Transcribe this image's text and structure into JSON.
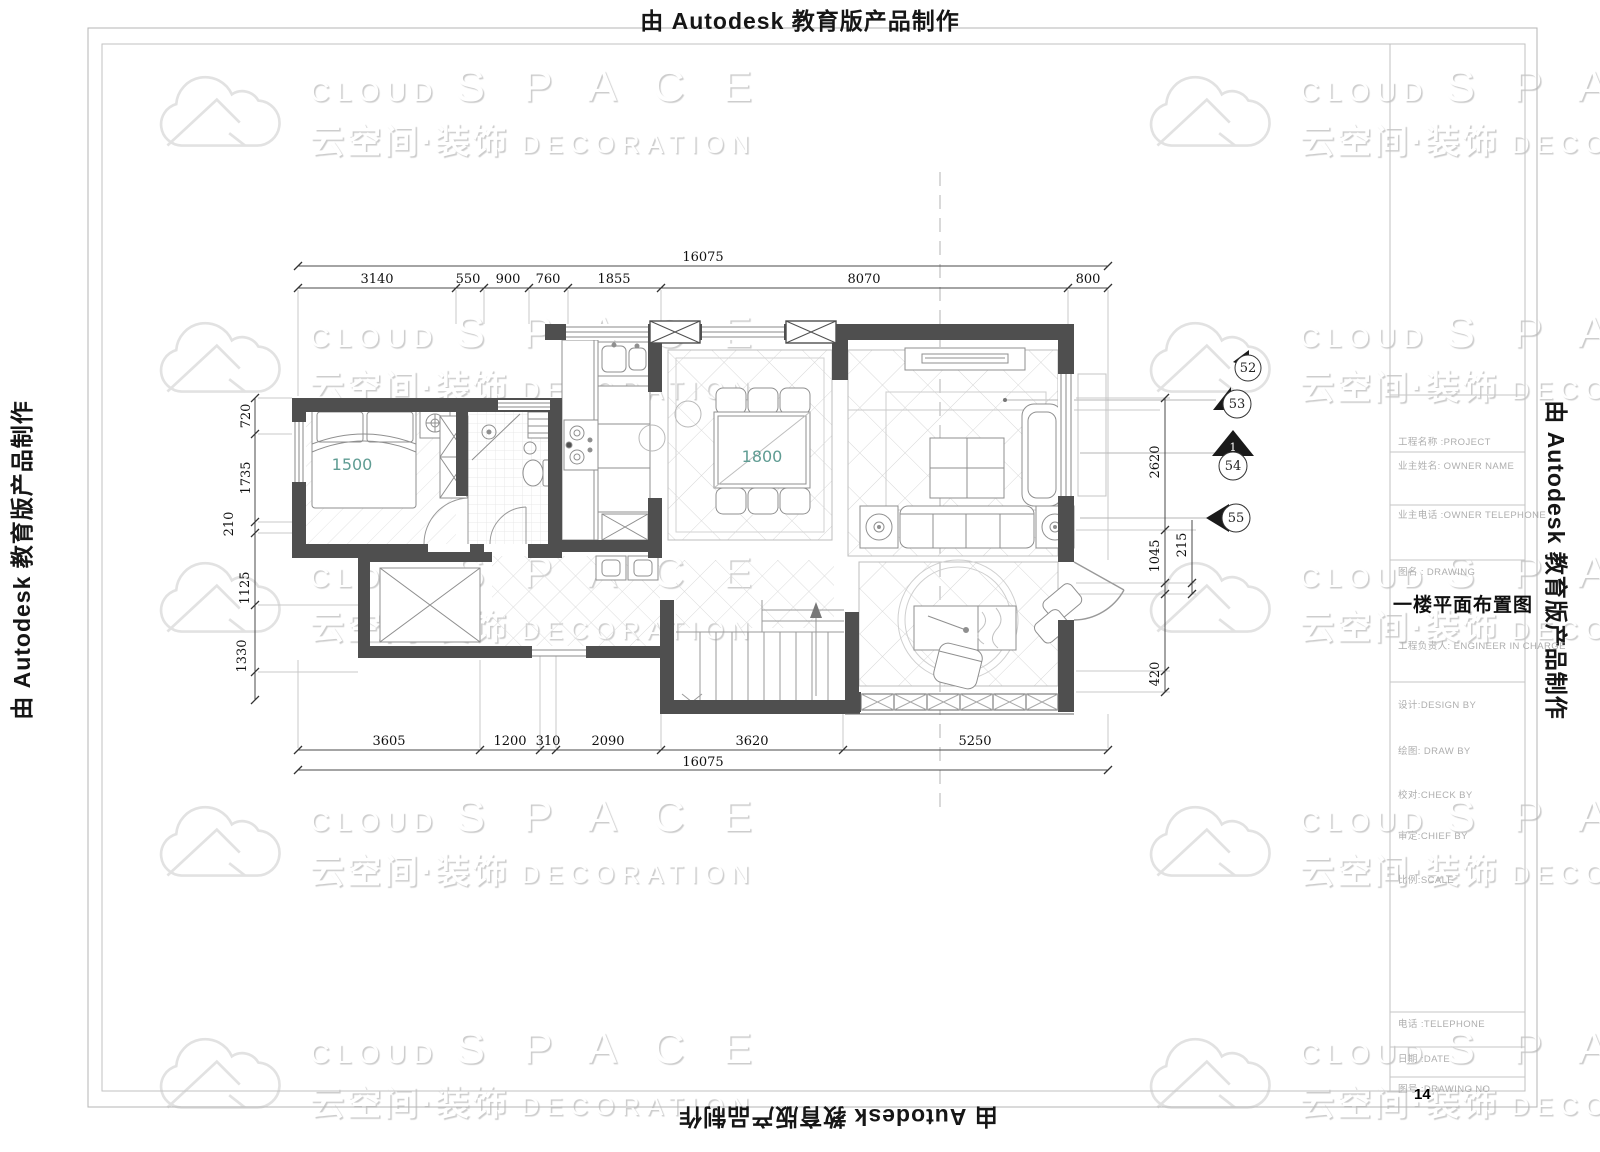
{
  "page": {
    "banner_text": "由 Autodesk 教育版产品制作"
  },
  "watermark": {
    "cloud": "CLOUD",
    "space": "S P A C E",
    "cjk": "云空间·装饰",
    "decoration": "DECORATION",
    "icon": "cloud-mountain-logo"
  },
  "title_block": {
    "project_label": "工程名称 :PROJECT",
    "owner_name_label": "业主姓名: OWNER NAME",
    "owner_tel_label": "业主电话 :OWNER TELEPHONE",
    "drawing_label": "图名 : DRAWING",
    "drawing_title": "一楼平面布置图",
    "engineer_label": "工程负责人: ENGINEER IN CHARGE",
    "design_label": "设计:DESIGN BY",
    "draw_label": "绘图: DRAW BY",
    "check_label": "校对:CHECK BY",
    "chief_label": "审定:CHIEF BY",
    "scale_label": "比例:SCALE",
    "telephone_label": "电话 :TELEPHONE",
    "date_label": "日期 :DATE",
    "drawing_no_label": "图号 :DRAWING NO",
    "drawing_no": "14"
  },
  "dimensions": {
    "top_total": "16075",
    "top_segments": [
      "3140",
      "550",
      "900",
      "760",
      "1855",
      "8070",
      "800"
    ],
    "bottom_segments": [
      "3605",
      "1200",
      "310",
      "2090",
      "3620",
      "5250"
    ],
    "bottom_total": "16075",
    "left_segments": [
      "720",
      "1735",
      "210",
      "1125",
      "1330"
    ],
    "right_segments": [
      "2620",
      "1045",
      "215",
      "420"
    ]
  },
  "plan": {
    "room_labels": {
      "bed": "1500",
      "dining_table": "1800"
    },
    "markers": {
      "m52": "52",
      "m53": "53",
      "m54": "54",
      "m54_view": "1",
      "m55": "55"
    }
  },
  "colors": {
    "wall": "#4f4f4f",
    "dim_text": "#101010",
    "room_label": "#5f9c93",
    "border_line": "#b5b5b5",
    "furniture_line": "#8f8f8f"
  }
}
